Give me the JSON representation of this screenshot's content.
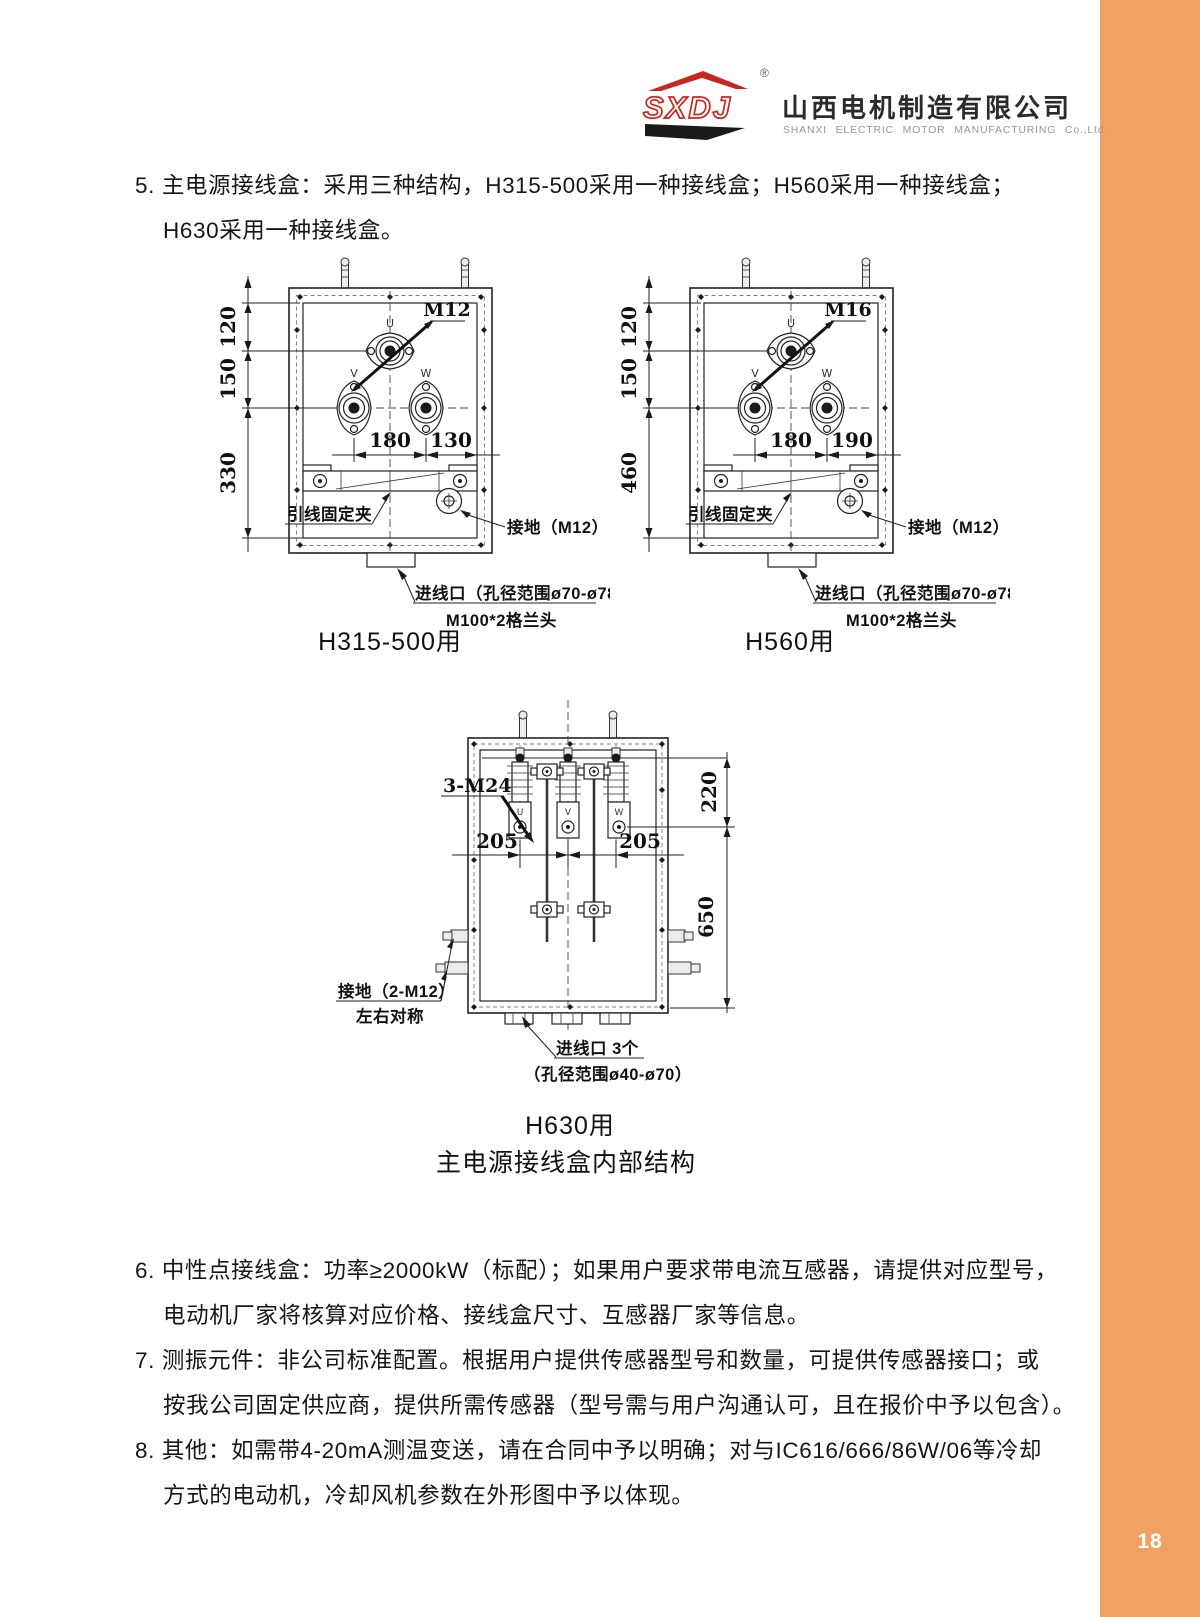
{
  "page": {
    "number": "18",
    "accent_color": "#F0A262"
  },
  "header": {
    "logo_abbr": "SXDJ",
    "registered": "®",
    "company_cn": "山西电机制造有限公司",
    "company_en": "SHANXI ELECTRIC MOTOR MANUFACTURING Co.,Ltd."
  },
  "notes": {
    "item5_line1": "5. 主电源接线盒：采用三种结构，H315-500采用一种接线盒；H560采用一种接线盒；",
    "item5_line2": "H630采用一种接线盒。",
    "item6_line1": "6. 中性点接线盒：功率≥2000kW（标配）；如果用户要求带电流互感器，请提供对应型号，",
    "item6_line2": "电动机厂家将核算对应价格、接线盒尺寸、互感器厂家等信息。",
    "item7_line1": "7. 测振元件：非公司标准配置。根据用户提供传感器型号和数量，可提供传感器接口；或",
    "item7_line2": "按我公司固定供应商，提供所需传感器（型号需与用户沟通认可，且在报价中予以包含）。",
    "item8_line1": "8. 其他：如需带4-20mA测温变送，请在合同中予以明确；对与IC616/666/86W/06等冷却",
    "item8_line2": "方式的电动机，冷却风机参数在外形图中予以体现。"
  },
  "figure_caption": "主电源接线盒内部结构",
  "diagram_left": {
    "caption": "H315-500用",
    "bolt_label": "M12",
    "terminal_u": "U",
    "terminal_v": "V",
    "terminal_w": "W",
    "dim_120": "120",
    "dim_150": "150",
    "dim_330": "330",
    "dim_180": "180",
    "dim_130": "130",
    "clamp_label": "引线固定夹",
    "ground_label": "接地（M12）",
    "inlet_line1": "进线口（孔径范围ø70-ø78）",
    "inlet_line2": "M100*2格兰头"
  },
  "diagram_right": {
    "caption": "H560用",
    "bolt_label": "M16",
    "terminal_u": "U",
    "terminal_v": "V",
    "terminal_w": "W",
    "dim_120": "120",
    "dim_150": "150",
    "dim_460": "460",
    "dim_180": "180",
    "dim_190": "190",
    "clamp_label": "引线固定夹",
    "ground_label": "接地（M12）",
    "inlet_line1": "进线口（孔径范围ø70-ø78）",
    "inlet_line2": "M100*2格兰头"
  },
  "diagram_h630": {
    "caption": "H630用",
    "bolt_label": "3-M24",
    "terminal_u": "U",
    "terminal_v": "V",
    "terminal_w": "W",
    "dim_220": "220",
    "dim_650": "650",
    "dim_205_left": "205",
    "dim_205_right": "205",
    "ground_line1": "接地（2-M12）",
    "ground_line2": "左右对称",
    "inlet_line1": "进线口 3个",
    "inlet_line2": "（孔径范围ø40-ø70）"
  }
}
